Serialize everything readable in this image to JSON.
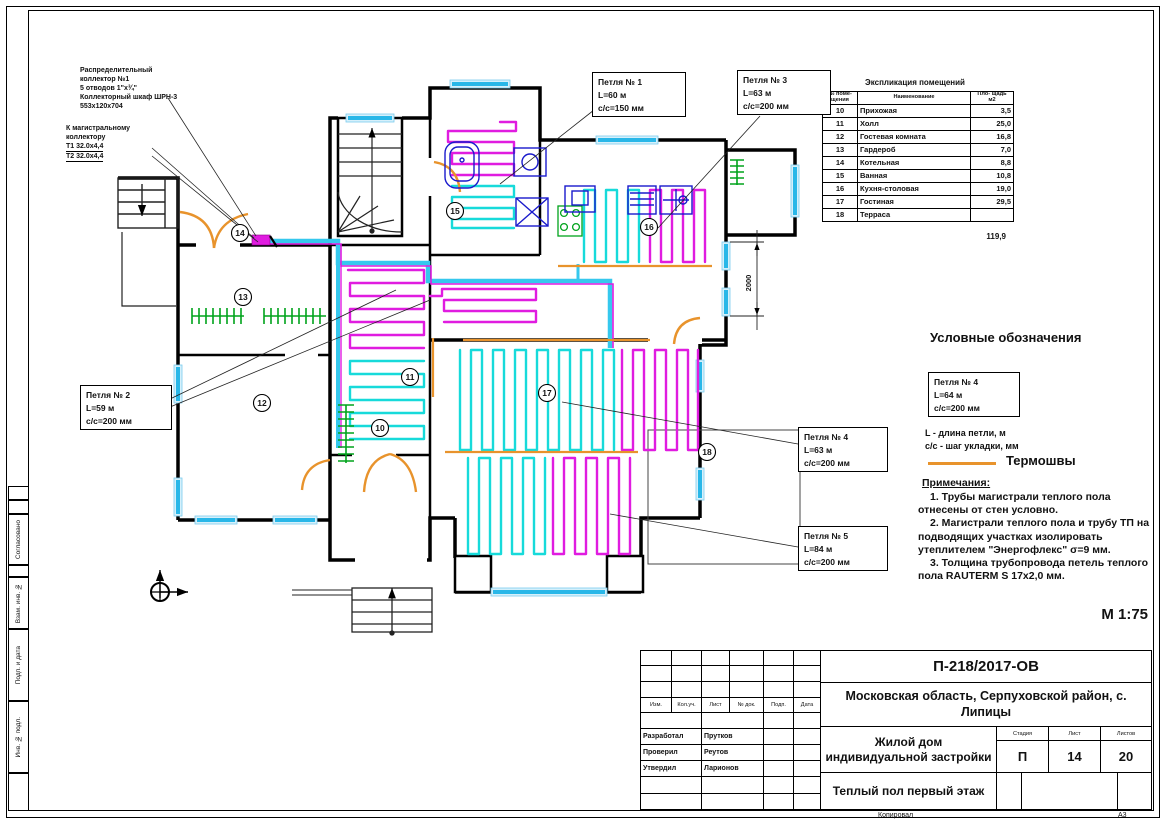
{
  "drawing": {
    "scale": "М 1:75",
    "format": "А3",
    "copied_by": "Копировал"
  },
  "stamp_sidebar": {
    "items": [
      "Согласовано",
      "Взам. инв. №",
      "Подп. и дата",
      "Инв. № подл."
    ]
  },
  "annotations": {
    "collector_lines": [
      "Распределительный",
      "коллектор №1",
      "5 отводов 1\"х¾\"",
      "Коллекторный шкаф ШРН-3",
      "553х120х704"
    ],
    "main_collector_lines": [
      "К магистральному",
      "коллектору"
    ],
    "t_lines": [
      "Т1 32.0х4,4",
      "Т2 32.0х4,4"
    ]
  },
  "loops": [
    {
      "title": "Петля № 1",
      "length": "L=60 м",
      "step": "с/с=150 мм"
    },
    {
      "title": "Петля № 2",
      "length": "L=59 м",
      "step": "с/с=200 мм"
    },
    {
      "title": "Петля № 3",
      "length": "L=63 м",
      "step": "с/с=200 мм"
    },
    {
      "title": "Петля № 4",
      "length": "L=63 м",
      "step": "с/с=200 мм"
    },
    {
      "title": "Петля № 5",
      "length": "L=84 м",
      "step": "с/с=200 мм"
    }
  ],
  "explication": {
    "title": "Экспликация помещений",
    "headers": [
      "№ поме- щения",
      "Наименование",
      "Пло- щадь м2"
    ],
    "rows": [
      [
        "10",
        "Прихожая",
        "3,5"
      ],
      [
        "11",
        "Холл",
        "25,0"
      ],
      [
        "12",
        "Гостевая комната",
        "16,8"
      ],
      [
        "13",
        "Гардероб",
        "7,0"
      ],
      [
        "14",
        "Котельная",
        "8,8"
      ],
      [
        "15",
        "Ванная",
        "10,8"
      ],
      [
        "16",
        "Кухня-столовая",
        "19,0"
      ],
      [
        "17",
        "Гостиная",
        "29,5"
      ],
      [
        "18",
        "Терраса",
        ""
      ]
    ],
    "total": "119,9"
  },
  "legend": {
    "title": "Условные обозначения",
    "example": {
      "title": "Петля № 4",
      "length": "L=64 м",
      "step": "с/с=200 мм"
    },
    "l_note": "L - длина петли, м",
    "cc_note": "с/с - шаг укладки, мм",
    "thermo_label": "Термошвы"
  },
  "notes": {
    "title": "Примечания:",
    "items": [
      "1. Трубы магистрали теплого пола отнесены от стен условно.",
      "2. Магистрали теплого пола и трубу ТП на подводящих участках изолировать утеплителем \"Энергофлекс\" σ=9 мм.",
      "3. Толщина трубопровода петель теплого пола RAUTERM S 17х2,0 мм."
    ]
  },
  "plan": {
    "rooms": [
      "10",
      "11",
      "12",
      "13",
      "14",
      "15",
      "16",
      "17",
      "18"
    ],
    "dimension": "2000"
  },
  "titleblock": {
    "doc_number": "П-218/2017-ОВ",
    "location": "Московская область, Серпуховской район, с. Липицы",
    "object": "Жилой дом индивидуальной застройки",
    "sheet_title": "Теплый пол первый этаж",
    "stage_label": "Стадия",
    "sheet_label": "Лист",
    "sheets_label": "Листов",
    "stage": "П",
    "sheet": "14",
    "sheets": "20",
    "cols": [
      "Изм.",
      "Кол.уч.",
      "Лист",
      "№ док.",
      "Подп.",
      "Дата"
    ],
    "roles": [
      {
        "role": "Разработал",
        "name": "Прутков"
      },
      {
        "role": "Проверил",
        "name": "Реутов"
      },
      {
        "role": "Утвердил",
        "name": "Ларионов"
      }
    ]
  }
}
